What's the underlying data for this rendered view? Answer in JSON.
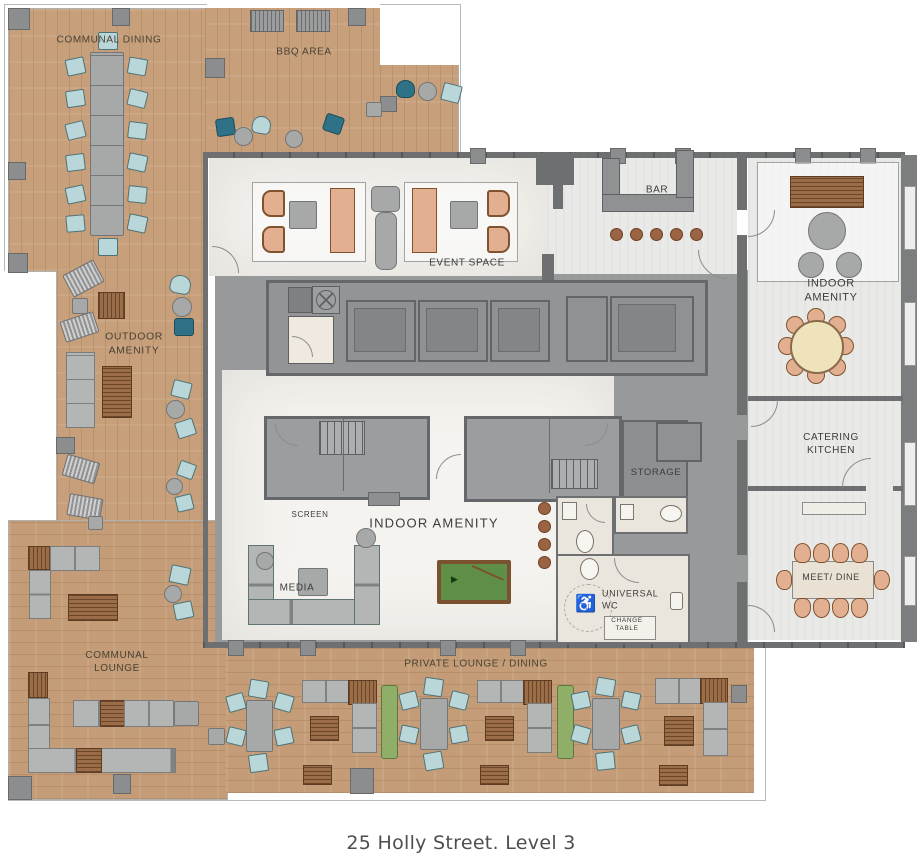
{
  "title": "Amenity floor plan",
  "caption": "25 Holly Street. Level 3",
  "rooms": {
    "communal_dining": "COMMUNAL DINING",
    "bbq_area": "BBQ AREA",
    "event_space": "EVENT SPACE",
    "bar": "BAR",
    "indoor_amenity_right": "INDOOR AMENITY",
    "outdoor_amenity": "OUTDOOR\nAMENITY",
    "catering_kitchen": "CATERING\nKITCHEN",
    "storage": "STORAGE",
    "screen": "SCREEN",
    "indoor_amenity_center": "INDOOR AMENITY",
    "media": "MEDIA",
    "universal_wc": "UNIVERSAL\nWC",
    "change_table": "CHANGE\nTABLE",
    "meet_dine": "MEET/ DINE",
    "communal_lounge": "COMMUNAL\nLOUNGE",
    "private_lounge_dining": "PRIVATE LOUNGE / DINING"
  },
  "icons": {
    "accessible_wc": "♿",
    "pool_rack": "▶"
  },
  "colors": {
    "wood_deck": "#c7a07b",
    "marble_floor": "#f4f3ef",
    "light_floor": "#e9e9e8",
    "core_gray": "#97999a",
    "wall_gray": "#6d6f71",
    "teal_chair": "#2f7186",
    "light_teal_chair": "#b9d6d8",
    "tan_seat": "#e2b091",
    "planter_green": "#8fae67",
    "pool_table_green": "#5f8f46",
    "furniture_wood": "#9a6c47",
    "label_text": "#4a4134"
  }
}
